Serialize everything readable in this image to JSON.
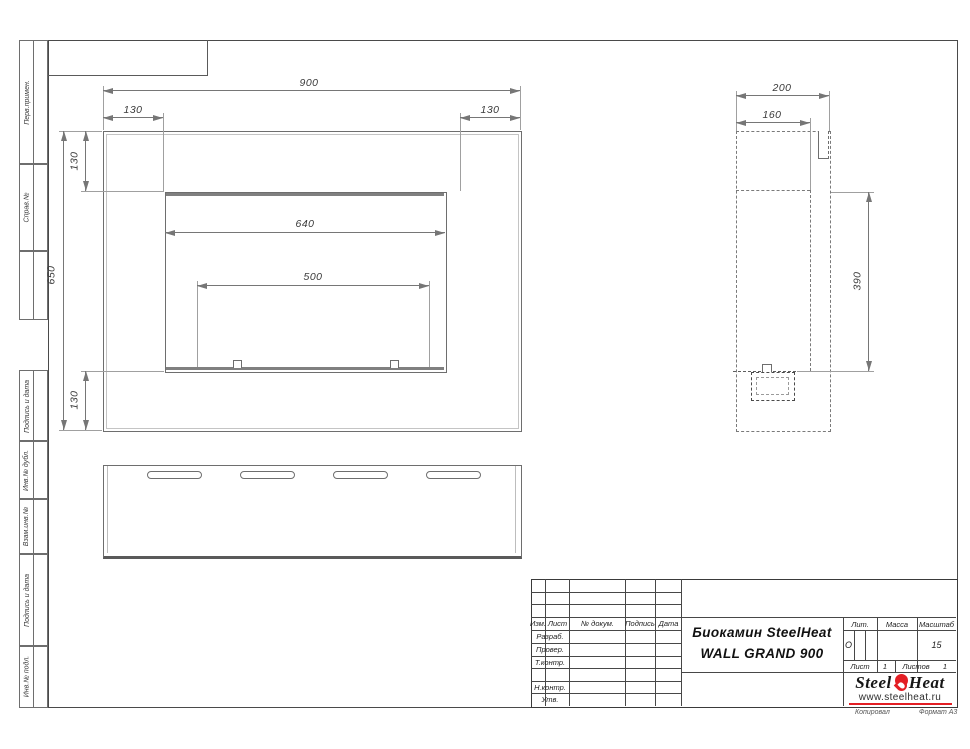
{
  "margin_labels": [
    "Перв.примен.",
    "Справ.№",
    "",
    "Подпись и дата",
    "Инв.№ дубл.",
    "Взам.инв.№",
    "Подпись и дата",
    "Инв.№ подл."
  ],
  "front_view": {
    "dims": {
      "overall_width": "900",
      "left_offset": "130",
      "right_offset": "130",
      "top_offset": "130",
      "overall_height": "650",
      "bottom_offset": "130",
      "opening_width": "640",
      "burner_width": "500"
    }
  },
  "side_view": {
    "dims": {
      "depth": "200",
      "inner_depth": "160",
      "opening_height": "390"
    }
  },
  "title_block": {
    "columns": {
      "izm": "Изм.",
      "list": "Лист",
      "doc": "№ докум.",
      "sign": "Подпись",
      "date": "Дата"
    },
    "rows": {
      "razrab": "Разраб.",
      "prover": "Провер.",
      "tkontr": "Т.контр.",
      "nkontr": "Н.контр.",
      "utv": "Утв."
    },
    "title_line1": "Биокамин SteelHeat",
    "title_line2": "WALL GRAND 900",
    "lit_header": "Лит.",
    "lit_value": "О",
    "mass_header": "Масса",
    "scale_header": "Масштаб",
    "scale_value": "15",
    "sheet_label": "Лист",
    "sheet_value": "1",
    "sheets_label": "Листов",
    "sheets_value": "1",
    "logo": {
      "part1": "Steel",
      "part2": "Heat",
      "url": "www.steelheat.ru",
      "flame_color": "#e31e24"
    },
    "kopiroval": "Копировал",
    "format": "Формат А3"
  }
}
